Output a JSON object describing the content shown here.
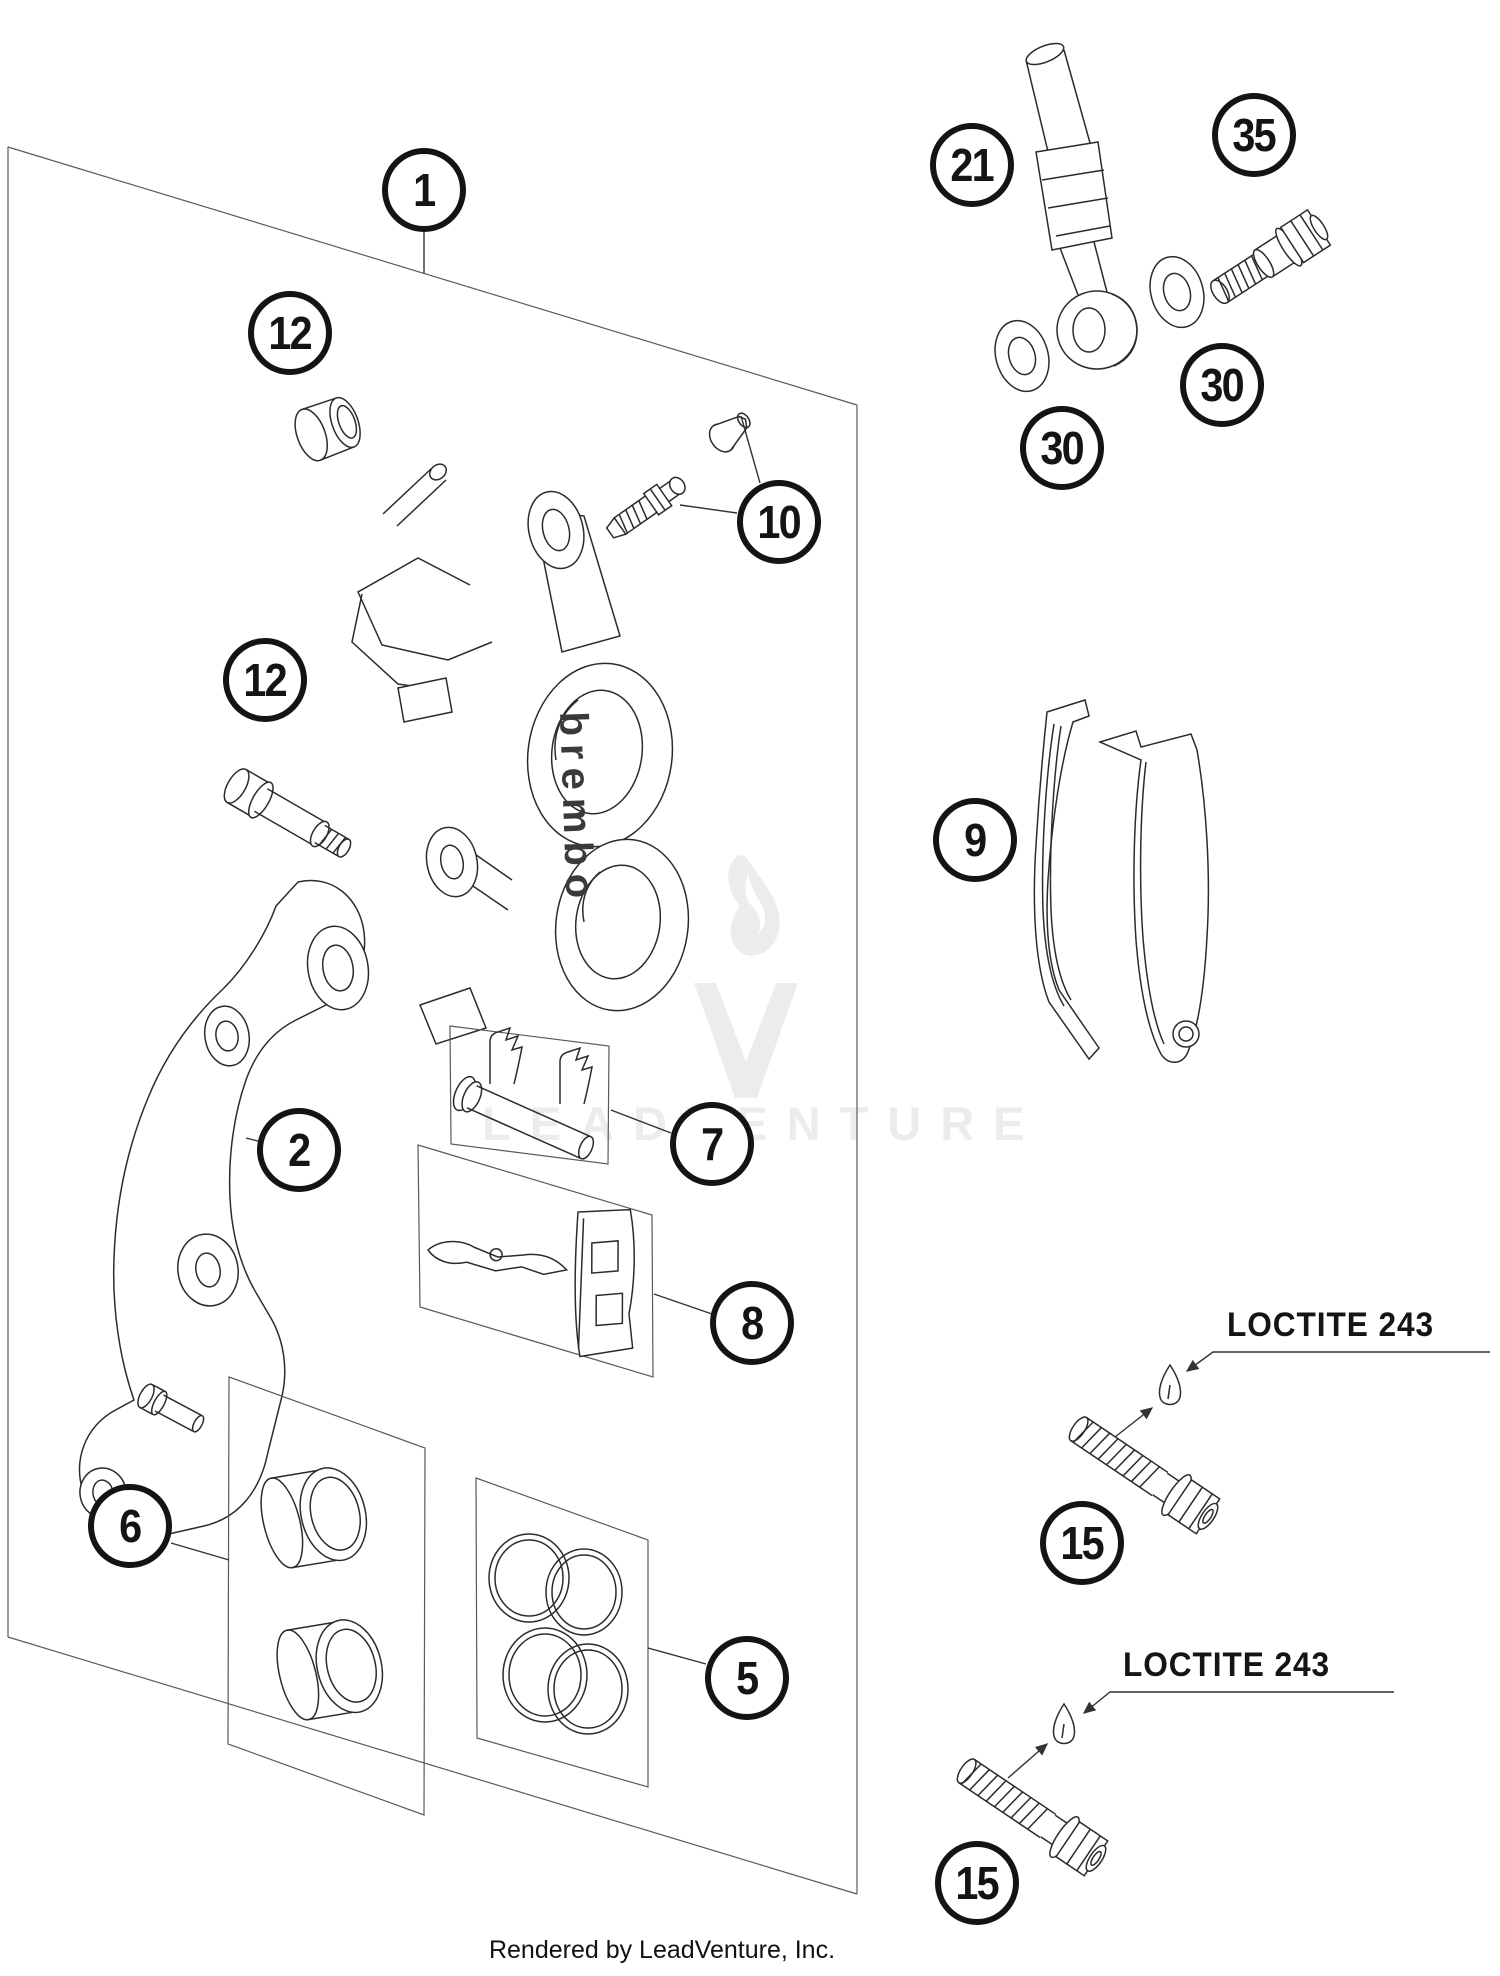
{
  "watermark": {
    "text": "LEADVENTURE",
    "logo_color": "#ececec"
  },
  "caption": {
    "text": "Rendered by LeadVenture, Inc."
  },
  "brand_label": {
    "text": "brembo"
  },
  "annotations": {
    "loctite_1": "LOCTITE 243",
    "loctite_2": "LOCTITE 243"
  },
  "callouts": [
    {
      "num": "1"
    },
    {
      "num": "12"
    },
    {
      "num": "12"
    },
    {
      "num": "10"
    },
    {
      "num": "2"
    },
    {
      "num": "7"
    },
    {
      "num": "8"
    },
    {
      "num": "9"
    },
    {
      "num": "6"
    },
    {
      "num": "5"
    },
    {
      "num": "21"
    },
    {
      "num": "35"
    },
    {
      "num": "30"
    },
    {
      "num": "30"
    },
    {
      "num": "15"
    },
    {
      "num": "15"
    }
  ]
}
